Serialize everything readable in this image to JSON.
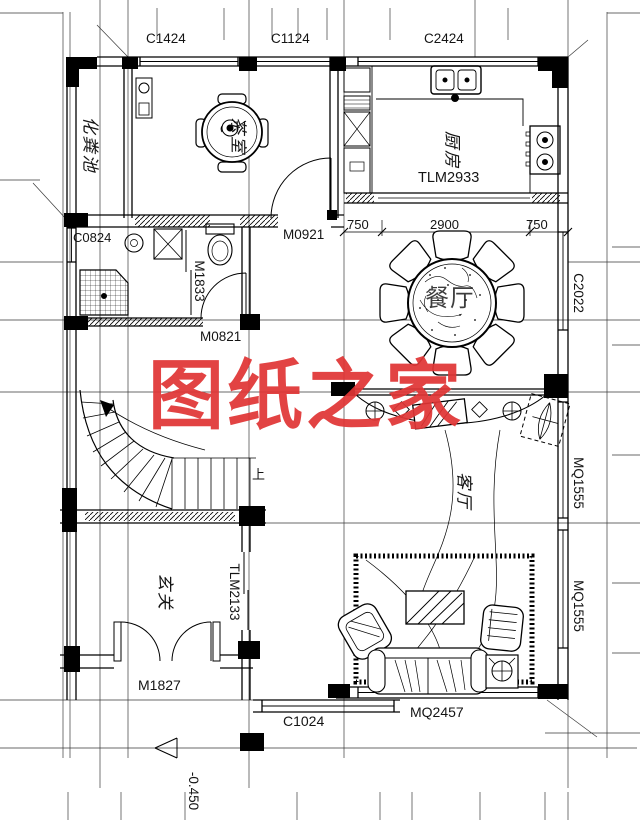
{
  "watermark": {
    "text": "图纸之家",
    "color": "#e03535"
  },
  "rooms": {
    "septic_tank": "化粪池",
    "tea_room": "茶室",
    "kitchen": "厨房",
    "dining_room": "餐厅",
    "living_room": "客厅",
    "entry_hall": "玄关"
  },
  "windows": {
    "c1424": "C1424",
    "c1124": "C1124",
    "c2424": "C2424",
    "c0824": "C0824",
    "c2022": "C2022",
    "c1024": "C1024",
    "mq1555_upper": "MQ1555",
    "mq1555_lower": "MQ1555",
    "mq2457": "MQ2457"
  },
  "doors": {
    "tlm2933": "TLM2933",
    "m0921": "M0921",
    "m1833": "M1833",
    "m0821": "M0821",
    "tlm2133": "TLM2133",
    "m1827": "M1827"
  },
  "dimensions": {
    "seg_left": "750",
    "seg_mid": "2900",
    "seg_right": "750",
    "floor_elevation": "-0.450"
  },
  "stairs": {
    "up_label": "上"
  }
}
